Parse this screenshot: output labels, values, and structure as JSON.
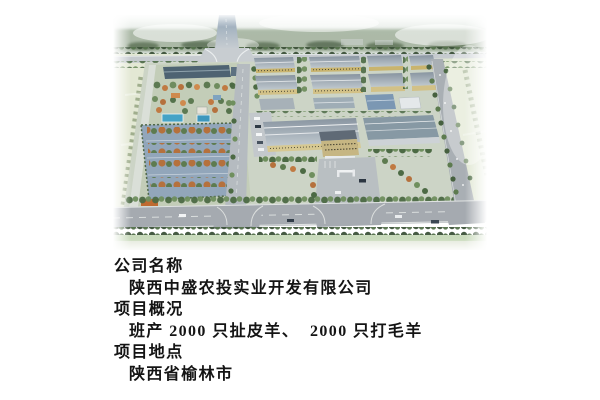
{
  "page": {
    "background": "#ffffff"
  },
  "photo": {
    "name": "aerial-rendering-of-industrial-park",
    "palette": {
      "sky_haze": "#e7ece8",
      "field_green": "#dfe6d2",
      "tree_dark": "#3c5239",
      "tree_mid": "#4c6a44",
      "tree_orange": "#b5713d",
      "road_gray": "#a5aab0",
      "roof_gray": "#9fadb6",
      "facade_yellow": "#c9b46e",
      "slate_roof": "#4e6372",
      "pool_blue": "#45a3c6",
      "orchard_court_blue": "#92a6ba"
    }
  },
  "info": {
    "lines": [
      {
        "text": "公司名称",
        "indent": false
      },
      {
        "text": "陕西中盛农投实业开发有限公司",
        "indent": true
      },
      {
        "text": "项目概况",
        "indent": false
      },
      {
        "text": "班产 2000 只扯皮羊、  2000 只打毛羊",
        "indent": true
      },
      {
        "text": "项目地点",
        "indent": false
      },
      {
        "text": "陕西省榆林市",
        "indent": true
      }
    ]
  }
}
